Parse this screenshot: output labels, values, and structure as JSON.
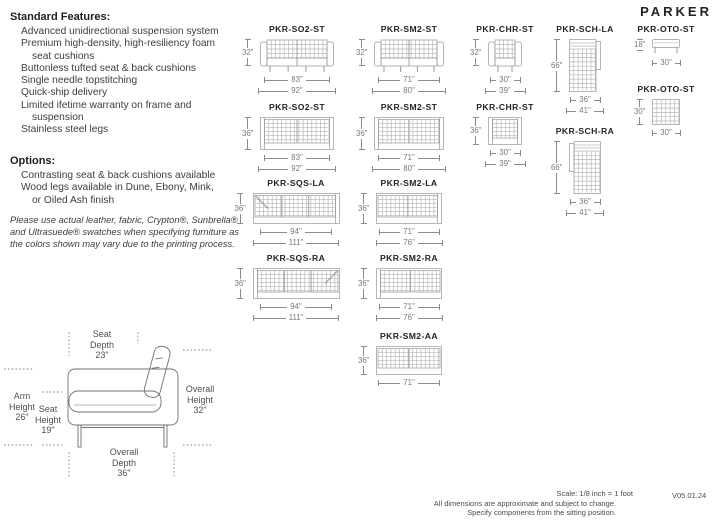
{
  "brand": "PARKER",
  "standard_features": {
    "heading": "Standard Features:",
    "items": [
      "Advanced unidirectional suspension system",
      "Premium high-density, high-resiliency foam\nseat cushions",
      "Buttonless tufted seat & back cushions",
      "Single needle topstitching",
      "Quick-ship delivery",
      "Limited ifetime warranty on frame and\nsuspension",
      "Stainless steel legs"
    ]
  },
  "options": {
    "heading": "Options:",
    "items": [
      "Contrasting seat & back cushions available",
      "Wood legs available in Dune, Ebony, Mink,\nor Oiled Ash finish"
    ]
  },
  "disclaimer": "Please use actual leather, fabric, Crypton®, Sunbrella®\nand Ultrasuede® swatches when specifying furniture as\nthe colors shown may vary due to the printing process.",
  "diagrams": [
    {
      "code": "PKR-SO2-ST",
      "height": "32\"",
      "widths": [
        "83\"",
        "92\""
      ]
    },
    {
      "code": "PKR-SM2-ST",
      "height": "32\"",
      "widths": [
        "71\"",
        "80\""
      ]
    },
    {
      "code": "PKR-CHR-ST",
      "height": "32\"",
      "widths": [
        "30\"",
        "39\""
      ]
    },
    {
      "code": "PKR-SCH-LA",
      "height": "66\"",
      "widths": [
        "36\"",
        "41\""
      ]
    },
    {
      "code": "PKR-OTO-ST",
      "height": "18\"",
      "widths": [
        "30\""
      ]
    },
    {
      "code": "PKR-OTO-ST",
      "height": "30\"",
      "widths": [
        "30\""
      ]
    },
    {
      "code": "PKR-SO2-ST",
      "height": "36\"",
      "widths": [
        "83\"",
        "92\""
      ]
    },
    {
      "code": "PKR-SM2-ST",
      "height": "36\"",
      "widths": [
        "71\"",
        "80\""
      ]
    },
    {
      "code": "PKR-CHR-ST",
      "height": "36\"",
      "widths": [
        "30\"",
        "39\""
      ]
    },
    {
      "code": "PKR-SCH-RA",
      "height": "66\"",
      "widths": [
        "36\"",
        "41\""
      ]
    },
    {
      "code": "PKR-SQS-LA",
      "height": "36\"",
      "widths": [
        "94\"",
        "111\""
      ]
    },
    {
      "code": "PKR-SM2-LA",
      "height": "36\"",
      "widths": [
        "71\"",
        "76\""
      ]
    },
    {
      "code": "PKR-SQS-RA",
      "height": "36\"",
      "widths": [
        "94\"",
        "111\""
      ]
    },
    {
      "code": "PKR-SM2-RA",
      "height": "36\"",
      "widths": [
        "71\"",
        "76\""
      ]
    },
    {
      "code": "PKR-SM2-AA",
      "height": "36\"",
      "widths": [
        "71\""
      ]
    }
  ],
  "profile": {
    "seat_depth": "Seat\nDepth\n23\"",
    "arm_height": "Arm\nHeight\n26\"",
    "seat_height": "Seat\nHeight\n19\"",
    "overall_height": "Overall\nHeight\n32\"",
    "overall_depth": "Overall\nDepth\n36\""
  },
  "footer": {
    "scale": "Scale: 1/8 inch = 1 foot",
    "note_line1": "All dimensions are approximate and subject to change.",
    "note_line2": "Specify components from the sitting position.",
    "version": "V05.01.24"
  },
  "colors": {
    "title_text": "#232325",
    "body_text": "#3c3d3f",
    "dimension_gray": "#77787b",
    "drawing_gray": "#97989b"
  }
}
